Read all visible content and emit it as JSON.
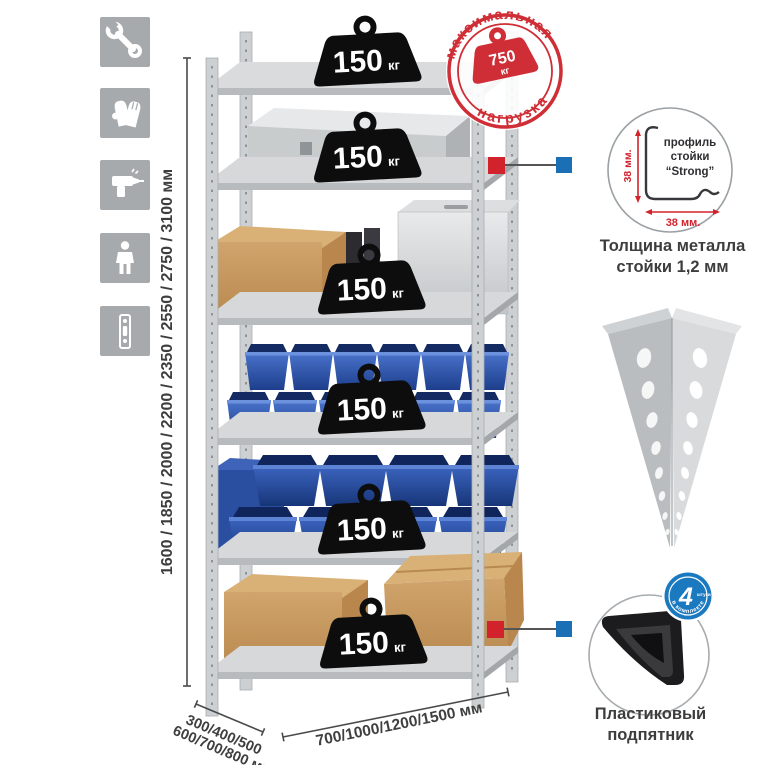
{
  "page": {
    "title": "Металлический стеллаж — характеристики"
  },
  "colors": {
    "accent_red": "#d2232d",
    "accent_blue": "#1b79c0",
    "stamp_red": "#cf2e36",
    "icon_gray": "#a6aaad",
    "text_dark": "#3d3d3d",
    "bin_blue": "#2a55ae",
    "cardboard": "#c89a62",
    "metal_gray": "#d2d4d6"
  },
  "left_icons": {
    "items": [
      {
        "name": "wrench-icon"
      },
      {
        "name": "gloves-icon"
      },
      {
        "name": "drill-icon"
      },
      {
        "name": "person-icon"
      },
      {
        "name": "post-strip-icon"
      }
    ]
  },
  "dimensions": {
    "height": "1600 / 1850 / 2000 / 2200 / 2350 / 2550 / 2750 / 3100 мм",
    "depth_line1": "300/400/500",
    "depth_line2": "600/700/800 мм",
    "width": "700/1000/1200/1500 мм"
  },
  "rack": {
    "shelves": 6,
    "load_value": "150",
    "load_unit": "кг"
  },
  "stamp": {
    "arc_top": "максимальная",
    "arc_bottom": "нагрузка",
    "value": "750",
    "unit": "кг"
  },
  "profile_feature": {
    "label1": "профиль",
    "label2": "стойки",
    "label3": "“Strong”",
    "dim_vertical": "38 мм.",
    "dim_horizontal": "38 мм.",
    "caption1": "Толщина металла",
    "caption2": "стойки 1,2 мм"
  },
  "foot_feature": {
    "badge_value": "4",
    "badge_note": "штуки",
    "badge_arc": "в комплекте",
    "caption1": "Пластиковый",
    "caption2": "подпятник"
  }
}
